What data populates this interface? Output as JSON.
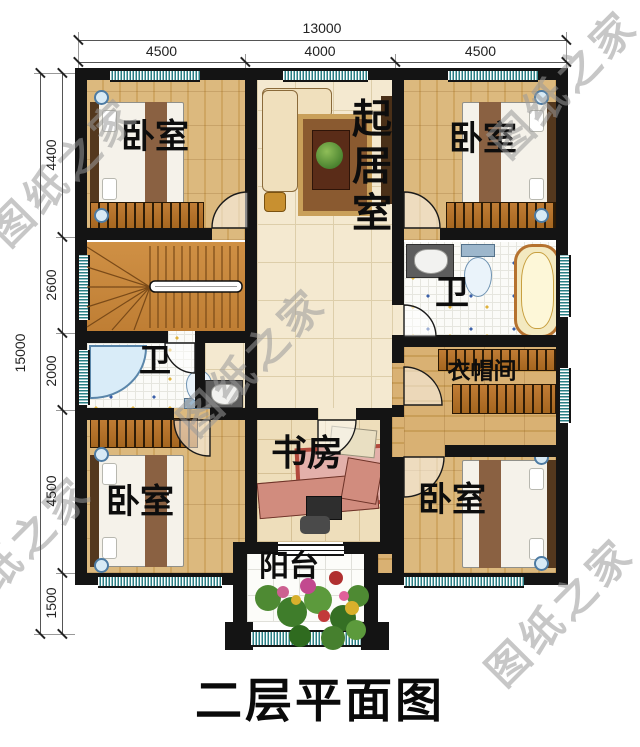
{
  "title": "二层平面图",
  "watermark": {
    "text": "图纸之家"
  },
  "dimensions": {
    "top": {
      "total": "13000",
      "segments": [
        "4500",
        "4000",
        "4500"
      ]
    },
    "left": {
      "total": "15000",
      "segments": [
        "4400",
        "2600",
        "2000",
        "4500",
        "1500"
      ]
    }
  },
  "rooms": {
    "bedroom_tl": "卧室",
    "bedroom_tr": "卧室",
    "bedroom_bl": "卧室",
    "bedroom_br": "卧室",
    "living": "起居室",
    "bath_left": "卫",
    "bath_right": "卫",
    "cloakroom": "衣帽间",
    "study": "书房",
    "balcony": "阳台"
  },
  "colors": {
    "wall": "#141414",
    "wood_floor": "#d8b274",
    "tile_cream": "#f4e9d0",
    "tile_study": "#eedebb",
    "window_teal": "#2a7f85",
    "stairs": "#c9873e",
    "wardrobe": "#b5722f",
    "water_blue": "#d9ecf8",
    "desk_pink": "#d18c7e"
  }
}
